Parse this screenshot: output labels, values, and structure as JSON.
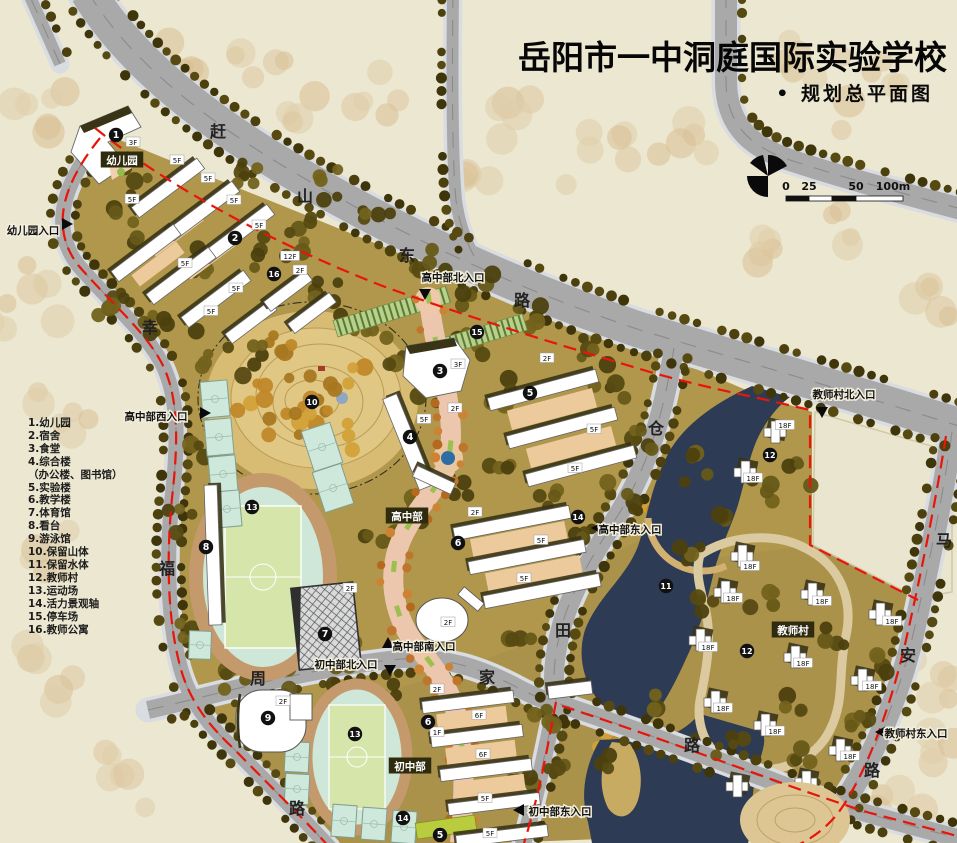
{
  "title": "岳阳市一中洞庭国际实验学校",
  "subtitle": "• 规划总平面图",
  "legend": {
    "items": [
      "1.幼儿园",
      "2.宿舍",
      "3.食堂",
      "4.综合楼",
      "（办公楼、图书馆）",
      "5.实验楼",
      "6.教学楼",
      "7.体育馆",
      "8.看台",
      "9.游泳馆",
      "10.保留山体",
      "11.保留水体",
      "12.教师村",
      "13.运动场",
      "14.活力景观轴",
      "15.停车场",
      "16.教师公寓"
    ]
  },
  "scale_bar": {
    "labels": [
      {
        "t": "0",
        "x": 786
      },
      {
        "t": "25",
        "x": 809
      },
      {
        "t": "50",
        "x": 856
      },
      {
        "t": "100m",
        "x": 893
      }
    ]
  },
  "roads": [
    {
      "name": "赶山东路",
      "chars": [
        {
          "t": "赶",
          "x": 218,
          "y": 131
        },
        {
          "t": "山",
          "x": 305,
          "y": 196
        },
        {
          "t": "东",
          "x": 407,
          "y": 255
        },
        {
          "t": "路",
          "x": 522,
          "y": 300
        }
      ]
    },
    {
      "name": "幸福路",
      "chars": [
        {
          "t": "幸",
          "x": 150,
          "y": 327
        },
        {
          "t": "福",
          "x": 167,
          "y": 568
        },
        {
          "t": "路",
          "x": 297,
          "y": 808
        }
      ]
    },
    {
      "name": "仓田路",
      "chars": [
        {
          "t": "仓",
          "x": 656,
          "y": 428
        },
        {
          "t": "田",
          "x": 563,
          "y": 630
        }
      ]
    },
    {
      "name": "周家路",
      "chars": [
        {
          "t": "周",
          "x": 258,
          "y": 678
        },
        {
          "t": "家",
          "x": 487,
          "y": 677
        },
        {
          "t": "路",
          "x": 692,
          "y": 745
        }
      ]
    },
    {
      "name": "马安路",
      "chars": [
        {
          "t": "马",
          "x": 944,
          "y": 540
        },
        {
          "t": "安",
          "x": 908,
          "y": 655
        },
        {
          "t": "路",
          "x": 872,
          "y": 770
        }
      ]
    }
  ],
  "entrances": [
    {
      "label": "幼儿园入口",
      "x": 33,
      "y": 230,
      "ax": 62,
      "ay": 224,
      "dir": "right"
    },
    {
      "label": "高中部西入口",
      "x": 156,
      "y": 416,
      "ax": 200,
      "ay": 413,
      "dir": "right"
    },
    {
      "label": "高中部北入口",
      "x": 453,
      "y": 277,
      "ax": 425,
      "ay": 289,
      "dir": "down"
    },
    {
      "label": "教师村北入口",
      "x": 844,
      "y": 394,
      "ax": 822,
      "ay": 407,
      "dir": "down"
    },
    {
      "label": "高中部东入口",
      "x": 630,
      "y": 529,
      "ax": 602,
      "ay": 528,
      "dir": "left"
    },
    {
      "label": "高中部南入口",
      "x": 424,
      "y": 646,
      "ax": 388,
      "ay": 648,
      "dir": "up"
    },
    {
      "label": "初中部北入口",
      "x": 346,
      "y": 664,
      "ax": 390,
      "ay": 665,
      "dir": "down"
    },
    {
      "label": "初中部东入口",
      "x": 560,
      "y": 811,
      "ax": 524,
      "ay": 810,
      "dir": "left"
    },
    {
      "label": "教师村东入口",
      "x": 916,
      "y": 733,
      "ax": 886,
      "ay": 732,
      "dir": "left"
    }
  ],
  "area_labels": [
    {
      "label": "幼儿园",
      "x": 122,
      "y": 160
    },
    {
      "label": "高中部",
      "x": 407,
      "y": 516
    },
    {
      "label": "初中部",
      "x": 410,
      "y": 766
    },
    {
      "label": "教师村",
      "x": 793,
      "y": 630
    }
  ],
  "markers": [
    {
      "n": "1",
      "x": 116,
      "y": 135
    },
    {
      "n": "2",
      "x": 235,
      "y": 238
    },
    {
      "n": "16",
      "x": 274,
      "y": 274
    },
    {
      "n": "15",
      "x": 477,
      "y": 332
    },
    {
      "n": "3",
      "x": 440,
      "y": 371
    },
    {
      "n": "10",
      "x": 312,
      "y": 402
    },
    {
      "n": "5",
      "x": 530,
      "y": 393
    },
    {
      "n": "4",
      "x": 410,
      "y": 437
    },
    {
      "n": "13",
      "x": 252,
      "y": 507
    },
    {
      "n": "14",
      "x": 578,
      "y": 517
    },
    {
      "n": "6",
      "x": 458,
      "y": 543
    },
    {
      "n": "8",
      "x": 206,
      "y": 547
    },
    {
      "n": "7",
      "x": 325,
      "y": 634
    },
    {
      "n": "11",
      "x": 666,
      "y": 586
    },
    {
      "n": "12",
      "x": 770,
      "y": 455
    },
    {
      "n": "12",
      "x": 747,
      "y": 651
    },
    {
      "n": "9",
      "x": 268,
      "y": 718
    },
    {
      "n": "13",
      "x": 355,
      "y": 734
    },
    {
      "n": "6",
      "x": 428,
      "y": 722
    },
    {
      "n": "14",
      "x": 403,
      "y": 818
    },
    {
      "n": "5",
      "x": 440,
      "y": 835
    }
  ],
  "floor_labels": [
    {
      "t": "3F",
      "x": 133,
      "y": 142
    },
    {
      "t": "5F",
      "x": 177,
      "y": 160
    },
    {
      "t": "5F",
      "x": 208,
      "y": 178
    },
    {
      "t": "5F",
      "x": 234,
      "y": 200
    },
    {
      "t": "5F",
      "x": 132,
      "y": 199
    },
    {
      "t": "5F",
      "x": 259,
      "y": 225
    },
    {
      "t": "5F",
      "x": 185,
      "y": 263
    },
    {
      "t": "12F",
      "x": 290,
      "y": 256
    },
    {
      "t": "2F",
      "x": 300,
      "y": 270
    },
    {
      "t": "5F",
      "x": 236,
      "y": 288
    },
    {
      "t": "5F",
      "x": 211,
      "y": 311
    },
    {
      "t": "3F",
      "x": 458,
      "y": 364
    },
    {
      "t": "2F",
      "x": 547,
      "y": 358
    },
    {
      "t": "2F",
      "x": 455,
      "y": 408
    },
    {
      "t": "5F",
      "x": 424,
      "y": 419
    },
    {
      "t": "5F",
      "x": 594,
      "y": 429
    },
    {
      "t": "5F",
      "x": 575,
      "y": 468
    },
    {
      "t": "2F",
      "x": 475,
      "y": 512
    },
    {
      "t": "5F",
      "x": 541,
      "y": 540
    },
    {
      "t": "5F",
      "x": 524,
      "y": 578
    },
    {
      "t": "2F",
      "x": 350,
      "y": 588
    },
    {
      "t": "2F",
      "x": 448,
      "y": 622
    },
    {
      "t": "2F",
      "x": 283,
      "y": 701
    },
    {
      "t": "2F",
      "x": 437,
      "y": 689
    },
    {
      "t": "6F",
      "x": 479,
      "y": 715
    },
    {
      "t": "1F",
      "x": 437,
      "y": 732
    },
    {
      "t": "6F",
      "x": 483,
      "y": 754
    },
    {
      "t": "5F",
      "x": 485,
      "y": 798
    },
    {
      "t": "5F",
      "x": 490,
      "y": 833
    },
    {
      "t": "18F",
      "x": 785,
      "y": 425
    },
    {
      "t": "18F",
      "x": 753,
      "y": 478
    },
    {
      "t": "18F",
      "x": 750,
      "y": 566
    },
    {
      "t": "18F",
      "x": 733,
      "y": 598
    },
    {
      "t": "18F",
      "x": 822,
      "y": 601
    },
    {
      "t": "18F",
      "x": 892,
      "y": 621
    },
    {
      "t": "18F",
      "x": 708,
      "y": 647
    },
    {
      "t": "18F",
      "x": 803,
      "y": 663
    },
    {
      "t": "18F",
      "x": 872,
      "y": 686
    },
    {
      "t": "18F",
      "x": 723,
      "y": 708
    },
    {
      "t": "18F",
      "x": 775,
      "y": 731
    },
    {
      "t": "18F",
      "x": 850,
      "y": 756
    }
  ],
  "colors": {
    "boundary_red": "#e8150a",
    "water": "#2e3b55",
    "road": "#a9a9a9",
    "road_casing": "#d9dce1",
    "campus_olive": "#a8924a",
    "hill_tan": "#d8bc74",
    "track_ring": "#c49a6d",
    "field_green": "#d6e5aa",
    "court_teal": "#cfe8dc",
    "axis_salmon": "#ecc7ae",
    "marker_black": "#111111",
    "label_box": "#2f2b0e",
    "outside_tree": "#dcc79f",
    "campus_tree": "#4c400e",
    "gold_tree": "#c08828",
    "orange_tree": "#bf752b"
  }
}
